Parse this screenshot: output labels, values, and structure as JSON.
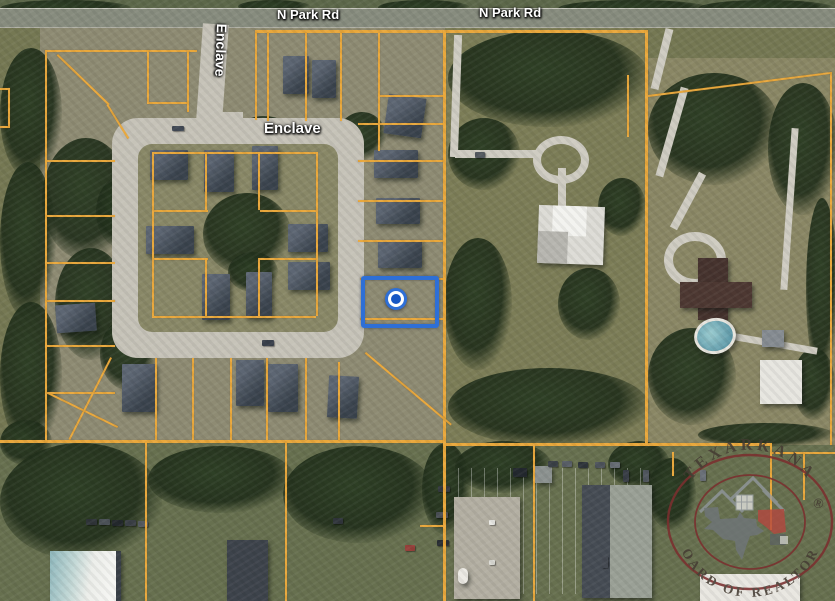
{
  "map": {
    "road_labels": {
      "n_park_rd_west": "N Park Rd",
      "n_park_rd_east": "N Park Rd",
      "enclave_vertical": "Enclave",
      "enclave_loop": "Enclave"
    },
    "parcel_line_color": "#E9A83C",
    "selected_parcel": {
      "highlight_color": "#2E6FD6",
      "marker_ring_color": "#2E6FD6",
      "marker_center_color": "#1757C4"
    }
  },
  "watermark": {
    "arc_top": "TEXARKANA",
    "arc_bottom": "BOARD OF REALTORS",
    "registered_symbol": "®",
    "ring_color": "#7B2F2F"
  }
}
